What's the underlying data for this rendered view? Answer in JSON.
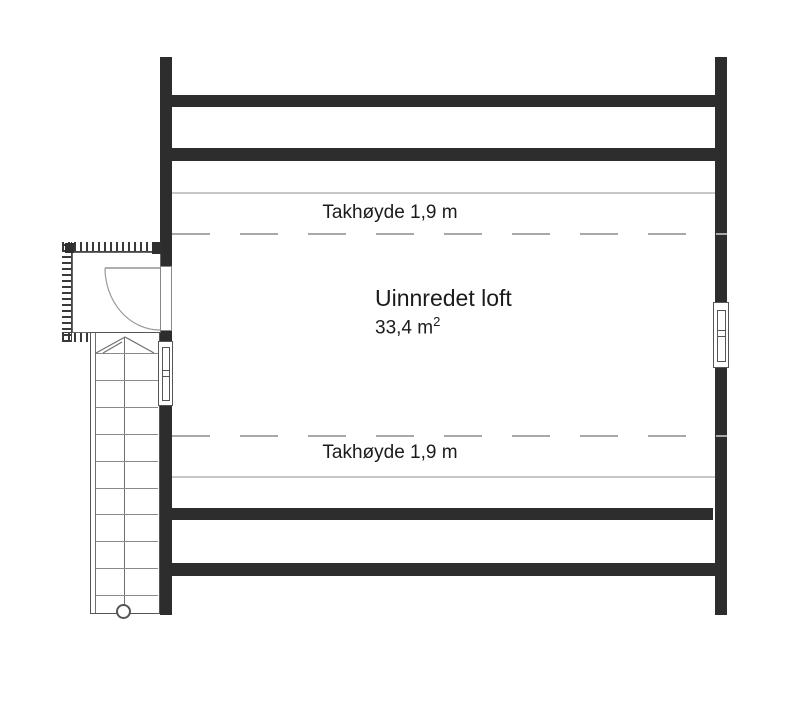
{
  "floorplan": {
    "room": {
      "name": "Uinnredet loft",
      "area_value": "33,4 m",
      "area_exponent": "2"
    },
    "annotations": {
      "ceiling_height_top": "Takhøyde 1,9 m",
      "ceiling_height_bottom": "Takhøyde 1,9 m"
    },
    "features": {
      "stairs": {
        "tread_count": 10,
        "tread_spacing_px": 26.9,
        "first_tread_offset_px": 20
      },
      "door": "entry-door-swing",
      "windows": [
        "left-wall-window",
        "right-wall-window"
      ],
      "vestibule": "insulated-entry"
    },
    "colors": {
      "wall": "#2d2d2d",
      "thin_line": "#c8c8c8",
      "dashed_line": "#a8a8a8",
      "stair_line": "#6f6f6f",
      "symbol_line": "#555555",
      "door_arc": "#9a9a9a",
      "text": "#1b1b1b",
      "background": "#ffffff"
    }
  }
}
